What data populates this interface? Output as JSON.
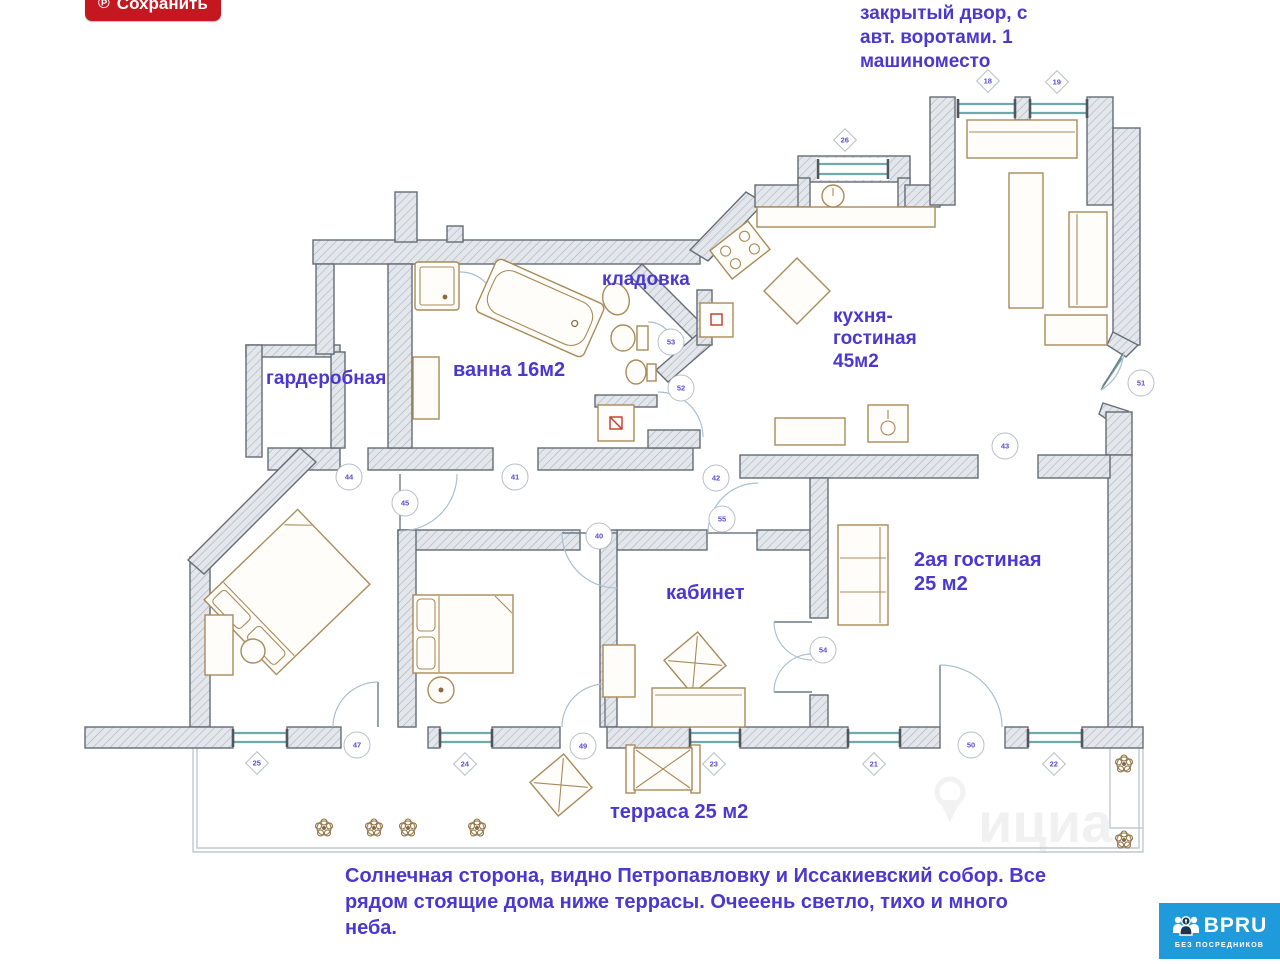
{
  "toolbar": {
    "save_label": "Сохранить",
    "save_icon": "℗"
  },
  "notes": {
    "top_right": "закрытый двор, с\nавт. воротами. 1\nмашиноместо",
    "bottom": "Солнечная сторона, видно Петропавловку и Иссакиевский собор. Все\nрядом стоящие дома ниже террасы. Очееень светло, тихо и много\nнеба."
  },
  "plan": {
    "rooms": [
      {
        "key": "kladovka",
        "label": "кладовка",
        "x": 602,
        "y": 269,
        "size": 19
      },
      {
        "key": "kitchen-living",
        "label": "кухня-\nгостиная\n45м2",
        "x": 833,
        "y": 306,
        "size": 19
      },
      {
        "key": "bath",
        "label": "ванна 16м2",
        "x": 453,
        "y": 359,
        "size": 20
      },
      {
        "key": "wardrobe",
        "label": "гардеробная",
        "x": 266,
        "y": 368,
        "size": 19
      },
      {
        "key": "office",
        "label": "кабинет",
        "x": 666,
        "y": 582,
        "size": 20
      },
      {
        "key": "second-living",
        "label": "2ая гостиная\n25 м2",
        "x": 914,
        "y": 549,
        "size": 20
      },
      {
        "key": "terrace",
        "label": "терраса 25 м2",
        "x": 610,
        "y": 801,
        "size": 20
      }
    ],
    "markers": [
      {
        "id": "26",
        "shape": "diamond",
        "x": 845,
        "y": 140
      },
      {
        "id": "18",
        "shape": "diamond",
        "x": 988,
        "y": 81
      },
      {
        "id": "19",
        "shape": "diamond",
        "x": 1057,
        "y": 82
      },
      {
        "id": "51",
        "shape": "circle",
        "x": 1141,
        "y": 383
      },
      {
        "id": "43",
        "shape": "circle",
        "x": 1005,
        "y": 446
      },
      {
        "id": "53",
        "shape": "circle",
        "x": 671,
        "y": 342
      },
      {
        "id": "52",
        "shape": "circle",
        "x": 681,
        "y": 388
      },
      {
        "id": "44",
        "shape": "circle",
        "x": 349,
        "y": 477
      },
      {
        "id": "41",
        "shape": "circle",
        "x": 515,
        "y": 477
      },
      {
        "id": "42",
        "shape": "circle",
        "x": 716,
        "y": 478
      },
      {
        "id": "45",
        "shape": "circle",
        "x": 405,
        "y": 503
      },
      {
        "id": "55",
        "shape": "circle",
        "x": 722,
        "y": 519
      },
      {
        "id": "40",
        "shape": "circle",
        "x": 599,
        "y": 536
      },
      {
        "id": "54",
        "shape": "circle",
        "x": 823,
        "y": 650
      },
      {
        "id": "25",
        "shape": "diamond",
        "x": 257,
        "y": 763
      },
      {
        "id": "47",
        "shape": "circle",
        "x": 357,
        "y": 745
      },
      {
        "id": "24",
        "shape": "diamond",
        "x": 465,
        "y": 764
      },
      {
        "id": "49",
        "shape": "circle",
        "x": 583,
        "y": 746
      },
      {
        "id": "23",
        "shape": "diamond",
        "x": 714,
        "y": 764
      },
      {
        "id": "21",
        "shape": "diamond",
        "x": 874,
        "y": 764
      },
      {
        "id": "50",
        "shape": "circle",
        "x": 971,
        "y": 745
      },
      {
        "id": "22",
        "shape": "diamond",
        "x": 1054,
        "y": 764
      }
    ],
    "watermark_letters": "ициа"
  },
  "logo": {
    "name": "BPRU",
    "tagline": "БЕЗ ПОСРЕДНИКОВ"
  },
  "colors": {
    "accent_text": "#4a38cf",
    "save_button": "#c5171f",
    "logo_bg": "#1f9ada",
    "wall_outline": "#656c75",
    "window": "#6fa9ad",
    "furniture": "#a98a5a",
    "marker_number": "#5a4cd4"
  }
}
